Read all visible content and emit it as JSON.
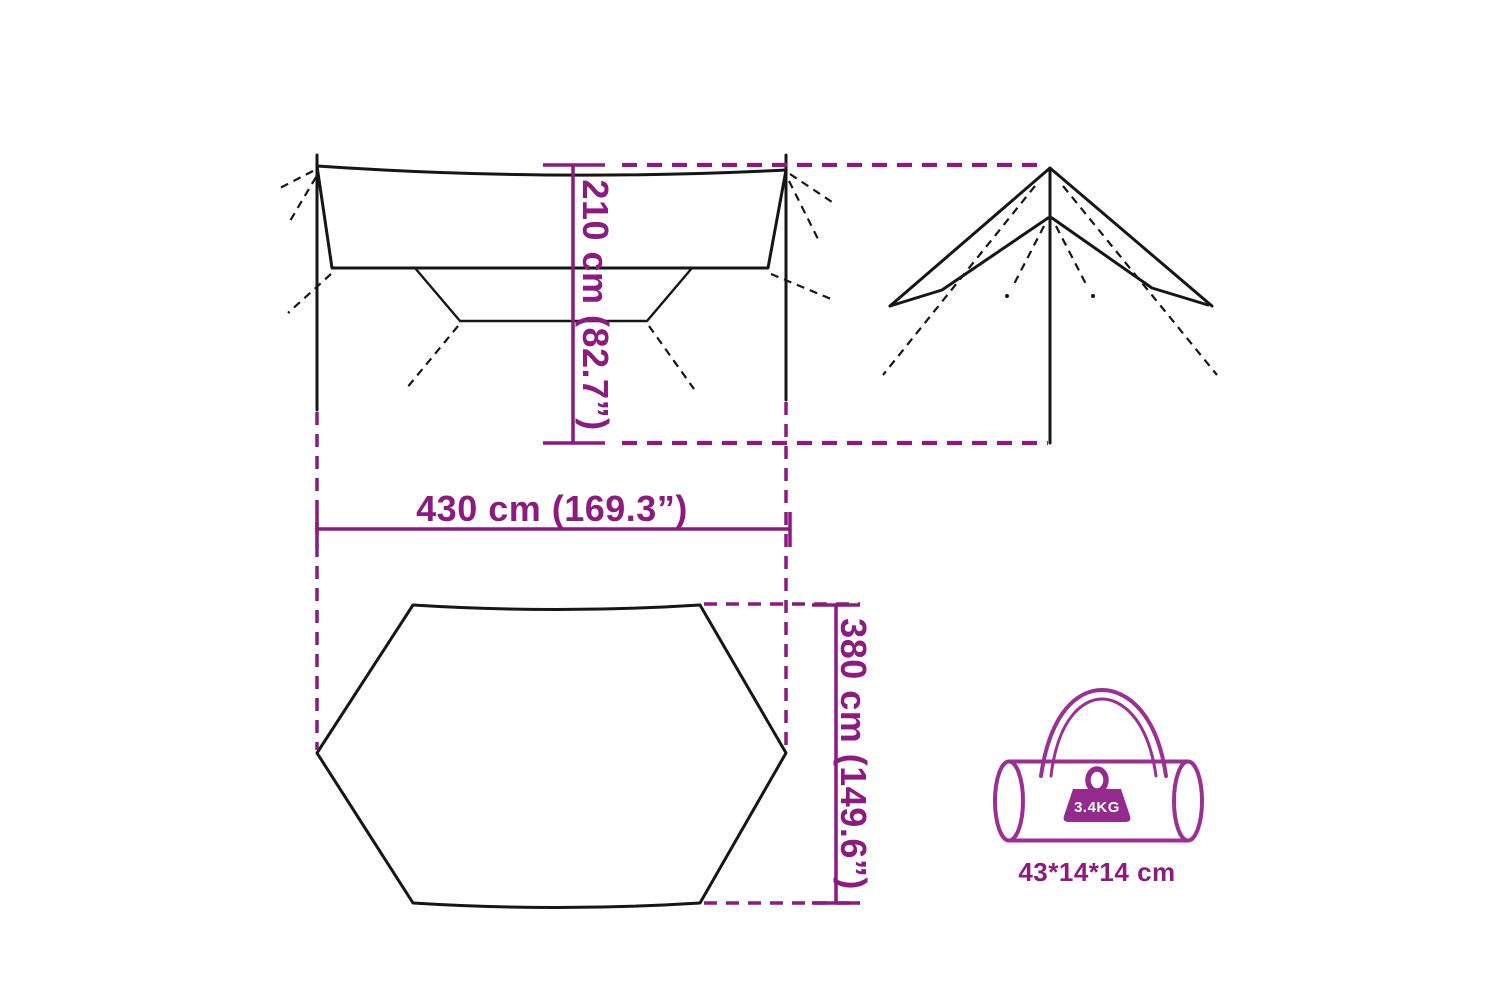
{
  "figure": {
    "dimensions": {
      "height": {
        "label": "210 cm (82.7”)"
      },
      "width": {
        "label": "430 cm (169.3”)"
      },
      "depth": {
        "label": "380 cm (149.6”)"
      }
    },
    "bag": {
      "weight": "3.4KG",
      "size": "43*14*14 cm"
    },
    "colors": {
      "dimension_magenta": "#8c1a7f",
      "bag_purple": "#9c2f94",
      "weight_icon_fill": "#952a8e",
      "line_black": "#161616",
      "background": "#ffffff"
    }
  }
}
